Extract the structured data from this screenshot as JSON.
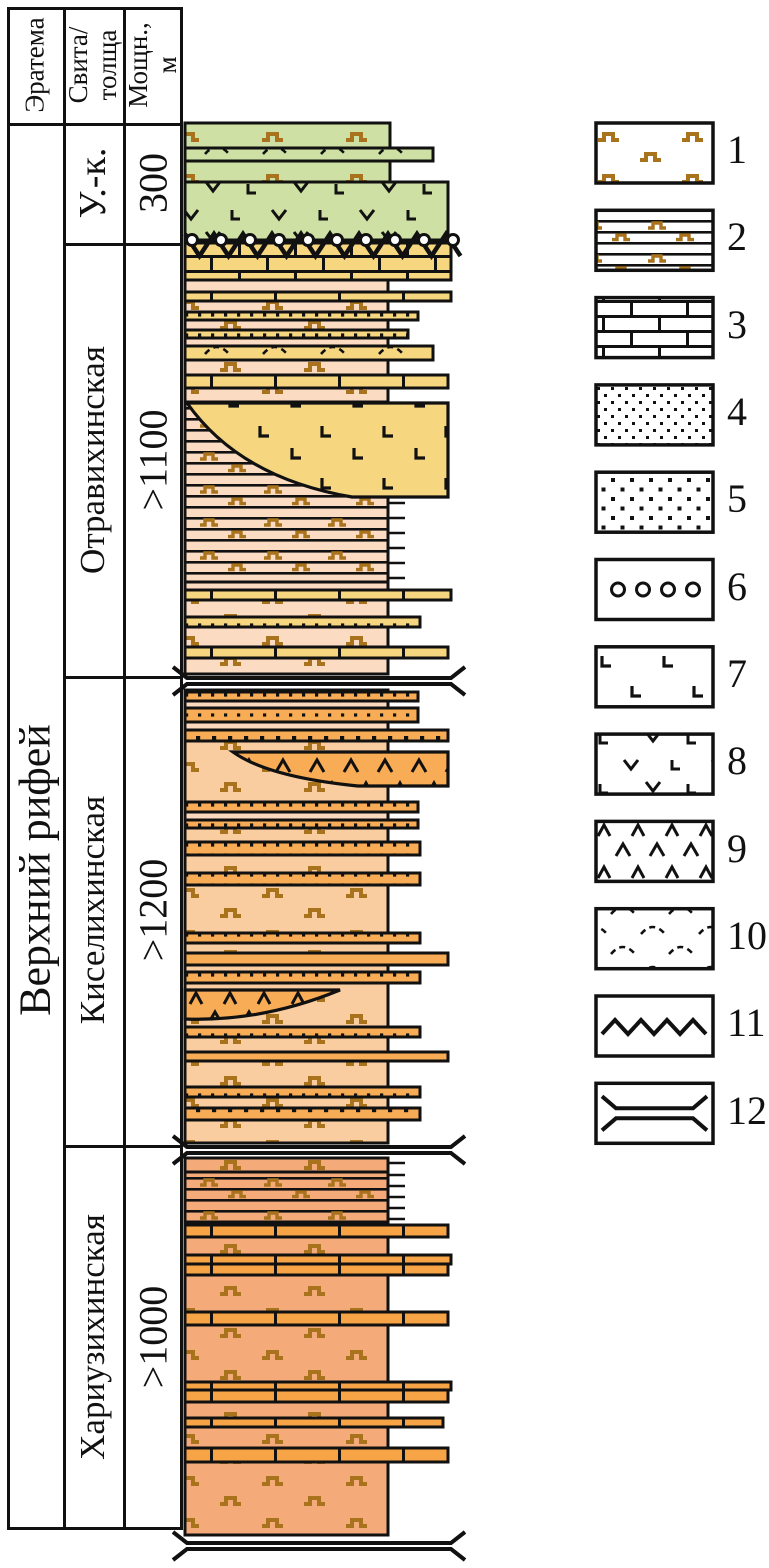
{
  "table": {
    "col1_header": "Эратема",
    "col2_header_lines": [
      "Свита/",
      "толща"
    ],
    "col3_header_lines": [
      "Мощн.,",
      "м"
    ],
    "era_label": "Верхний рифей",
    "rows": [
      {
        "suite": "У.-к.",
        "thickness": "300"
      },
      {
        "suite": "Отравихинская",
        "thickness": ">1100"
      },
      {
        "suite": "Киселихинская",
        "thickness": ">1200"
      },
      {
        "suite": "Хариузихинская",
        "thickness": ">1000"
      }
    ]
  },
  "colors": {
    "ink": "#111111",
    "brown": "#a9731d",
    "green": "#cfe0a4",
    "yellow": "#f6d67e",
    "pink": "#fbdcc3",
    "light": "#fbd9bf",
    "kbg": "#facda1",
    "kbed": "#f8ac55",
    "hbg": "#f5aa7a",
    "hbed": "#f7a447"
  },
  "column": {
    "x": 185,
    "units": [
      {
        "name": "uk-volcanic-unit",
        "beds": [
          {
            "y": 123,
            "h": 25,
            "w": 205,
            "f": "green",
            "p": "dash"
          },
          {
            "y": 148,
            "h": 13,
            "w": 248,
            "f": "green",
            "p": "arcs"
          },
          {
            "y": 161,
            "h": 21,
            "w": 205,
            "f": "green",
            "p": "dash"
          },
          {
            "y": 182,
            "h": 58,
            "w": 263,
            "f": "green",
            "p": "vl"
          }
        ]
      },
      {
        "name": "otravikhinskaya-unit",
        "beds": [
          {
            "y": 243,
            "h": 37,
            "w": 266,
            "f": "yellow",
            "p": "brick"
          },
          {
            "y": 280,
            "h": 12,
            "w": 203,
            "f": "pink"
          },
          {
            "y": 292,
            "h": 9,
            "w": 266,
            "f": "yellow",
            "p": "brickv"
          },
          {
            "y": 301,
            "h": 11,
            "w": 203,
            "f": "pink",
            "p": "dash"
          },
          {
            "y": 312,
            "h": 8,
            "w": 233,
            "f": "yellow",
            "p": "dots"
          },
          {
            "y": 320,
            "h": 10,
            "w": 203,
            "f": "pink",
            "p": "dash"
          },
          {
            "y": 330,
            "h": 8,
            "w": 223,
            "f": "yellow",
            "p": "dots"
          },
          {
            "y": 338,
            "h": 8,
            "w": 203,
            "f": "pink"
          },
          {
            "y": 346,
            "h": 14,
            "w": 248,
            "f": "yellow",
            "p": "arcs"
          },
          {
            "y": 360,
            "h": 15,
            "w": 203,
            "f": "pink",
            "p": "dash"
          },
          {
            "y": 375,
            "h": 13,
            "w": 263,
            "f": "yellow",
            "p": "brickv"
          },
          {
            "y": 388,
            "h": 14,
            "w": 203,
            "f": "pink",
            "p": "dash"
          },
          {
            "y": 402,
            "h": 180,
            "w": 203,
            "f": "pink",
            "p": "lamdash"
          },
          {
            "y": 582,
            "h": 8,
            "w": 203,
            "f": "pink"
          },
          {
            "y": 590,
            "h": 10,
            "w": 266,
            "f": "yellow",
            "p": "brickv"
          },
          {
            "y": 600,
            "h": 17,
            "w": 203,
            "f": "pink",
            "p": "dash"
          },
          {
            "y": 617,
            "h": 10,
            "w": 235,
            "f": "yellow",
            "p": "dots"
          },
          {
            "y": 627,
            "h": 20,
            "w": 203,
            "f": "pink",
            "p": "dash"
          },
          {
            "y": 647,
            "h": 11,
            "w": 263,
            "f": "yellow",
            "p": "brickv"
          },
          {
            "y": 658,
            "h": 16,
            "w": 203,
            "f": "pink",
            "p": "dash"
          }
        ],
        "lenses": [
          {
            "d": "M187,403 H448 V497 H352 Q240,478 187,403 Z",
            "f": "yellow",
            "p": "L"
          }
        ]
      },
      {
        "name": "kiselikhinskaya-unit",
        "beds": [
          {
            "y": 690,
            "h": 453,
            "w": 203,
            "f": "kbg",
            "p": "dash"
          },
          {
            "y": 692,
            "h": 9,
            "w": 233,
            "f": "kbed",
            "p": "dots"
          },
          {
            "y": 701,
            "h": 7,
            "w": 203,
            "f": "light"
          },
          {
            "y": 708,
            "h": 14,
            "w": 233,
            "f": "kbed",
            "p": "dots"
          },
          {
            "y": 722,
            "h": 8,
            "w": 203,
            "f": "light"
          },
          {
            "y": 730,
            "h": 11,
            "w": 263,
            "f": "kbed",
            "p": "dotsbig"
          },
          {
            "y": 802,
            "h": 10,
            "w": 233,
            "f": "kbed",
            "p": "dots"
          },
          {
            "y": 812,
            "h": 8,
            "w": 203,
            "f": "light"
          },
          {
            "y": 820,
            "h": 8,
            "w": 233,
            "f": "kbed",
            "p": "dots"
          },
          {
            "y": 842,
            "h": 13,
            "w": 235,
            "f": "kbed",
            "p": "dots"
          },
          {
            "y": 873,
            "h": 12,
            "w": 235,
            "f": "kbed",
            "p": "dots"
          },
          {
            "y": 933,
            "h": 10,
            "w": 235,
            "f": "kbed",
            "p": "dots"
          },
          {
            "y": 953,
            "h": 12,
            "w": 263,
            "f": "kbed"
          },
          {
            "y": 972,
            "h": 11,
            "w": 235,
            "f": "kbed",
            "p": "dots"
          },
          {
            "y": 1027,
            "h": 10,
            "w": 235,
            "f": "kbed",
            "p": "dots"
          },
          {
            "y": 1052,
            "h": 9,
            "w": 263,
            "f": "kbed"
          },
          {
            "y": 1087,
            "h": 10,
            "w": 235,
            "f": "kbed",
            "p": "dots"
          },
          {
            "y": 1108,
            "h": 12,
            "w": 235,
            "f": "kbed",
            "p": "dotsbig"
          }
        ],
        "lenses": [
          {
            "d": "M233,752 H448 V786 H358 Q268,777 233,752 Z",
            "f": "kbed",
            "p": "lambda"
          },
          {
            "d": "M185,990 H340 Q262,1022 185,1019 Z",
            "f": "kbed",
            "p": "lambda"
          }
        ]
      },
      {
        "name": "khariuzikhinskaya-unit",
        "beds": [
          {
            "y": 1158,
            "h": 377,
            "w": 203,
            "f": "hbg",
            "p": "dash"
          },
          {
            "y": 1172,
            "h": 50,
            "w": 203,
            "f": "hbg",
            "p": "lamdash"
          },
          {
            "y": 1225,
            "h": 12,
            "w": 263,
            "f": "hbed",
            "p": "brickv"
          },
          {
            "y": 1255,
            "h": 9,
            "w": 266,
            "f": "hbed",
            "p": "brickv"
          },
          {
            "y": 1264,
            "h": 11,
            "w": 263,
            "f": "hbed",
            "p": "brickv"
          },
          {
            "y": 1312,
            "h": 13,
            "w": 263,
            "f": "hbed",
            "p": "brickv"
          },
          {
            "y": 1382,
            "h": 8,
            "w": 266,
            "f": "hbed",
            "p": "brickv"
          },
          {
            "y": 1390,
            "h": 12,
            "w": 263,
            "f": "hbed",
            "p": "brickv"
          },
          {
            "y": 1418,
            "h": 9,
            "w": 258,
            "f": "hbed",
            "p": "brickv"
          },
          {
            "y": 1448,
            "h": 14,
            "w": 263,
            "f": "hbed",
            "p": "brickv"
          }
        ]
      }
    ],
    "zigzag": {
      "x0": 185,
      "x1": 466,
      "step": 14.5,
      "ytop": 234,
      "ybot": 256,
      "circles": 10,
      "cx0": 192,
      "cspace": 29,
      "cy": 240,
      "r": 5.5
    },
    "breaks": [
      681,
      1150,
      1546
    ],
    "ticks": [
      {
        "x": 388,
        "len": 17,
        "ys": [
          503,
          518,
          533,
          548,
          563,
          578
        ]
      },
      {
        "x": 388,
        "len": 17,
        "ys": [
          1163,
          1175,
          1186,
          1197,
          1208,
          1219
        ]
      }
    ]
  },
  "legend": {
    "x": 596,
    "y0": 123,
    "step": 87.3,
    "w": 117,
    "h": 60,
    "items": [
      {
        "num": "1",
        "pattern": "dash"
      },
      {
        "num": "2",
        "pattern": "lamdash"
      },
      {
        "num": "3",
        "pattern": "brick"
      },
      {
        "num": "4",
        "pattern": "densedots"
      },
      {
        "num": "5",
        "pattern": "sparsedots"
      },
      {
        "num": "6",
        "pattern": "circles"
      },
      {
        "num": "7",
        "pattern": "L"
      },
      {
        "num": "8",
        "pattern": "vl"
      },
      {
        "num": "9",
        "pattern": "lambda"
      },
      {
        "num": "10",
        "pattern": "arcs"
      },
      {
        "num": "11",
        "pattern": "zigzag"
      },
      {
        "num": "12",
        "pattern": "break"
      }
    ]
  }
}
